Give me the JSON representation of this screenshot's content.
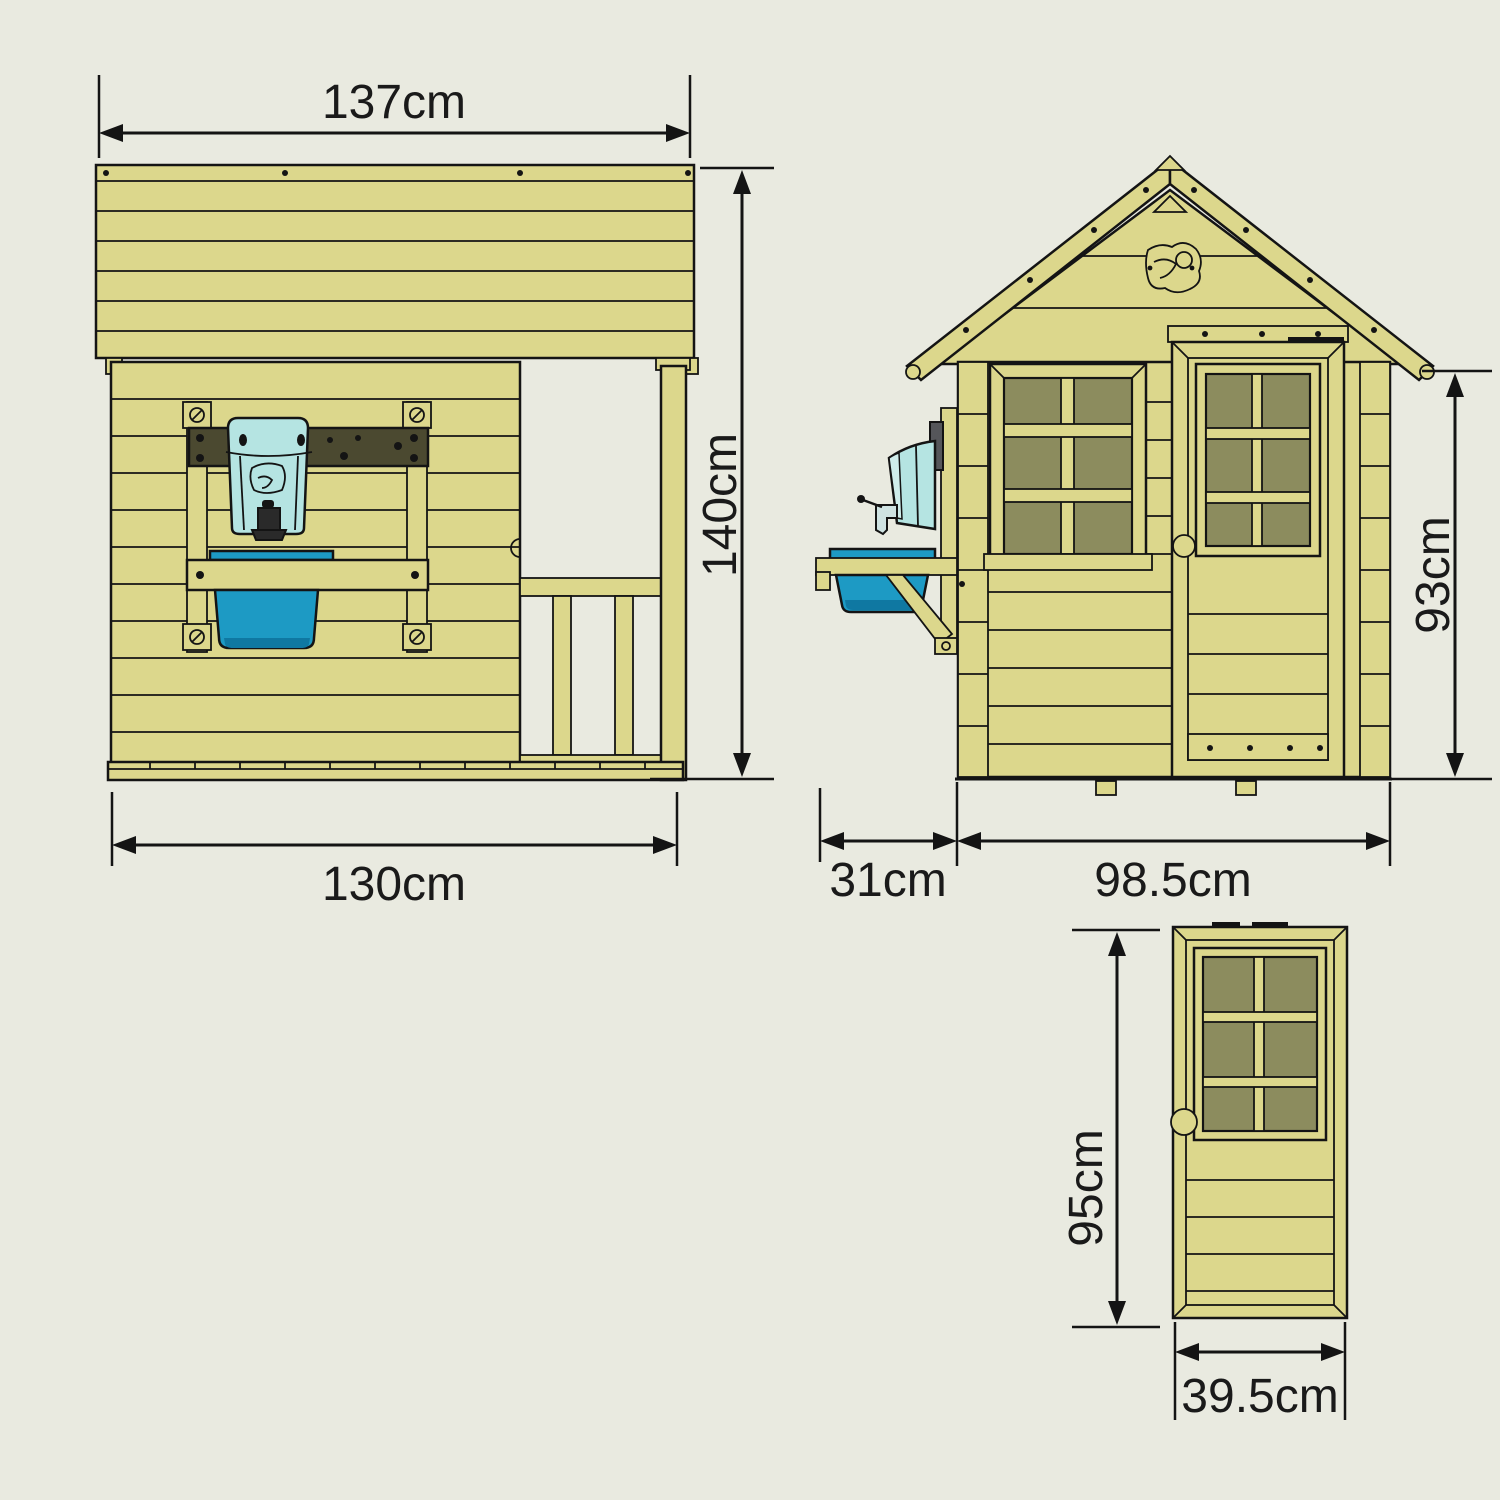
{
  "background": "#E9EAE0",
  "colors": {
    "wood": "#DCD78C",
    "outline": "#141414",
    "window_glass": "#8C8C5E",
    "mounting_board_brown": "#4B4930",
    "water_dispenser_blue": "#B5E4E2",
    "tub_blue": "#1D9AC4",
    "tub_shadow_blue": "#0F78A2",
    "bracket_gray": "#55565A"
  },
  "views": {
    "side": {
      "name": "side-elevation",
      "dim_roof_width": "137cm",
      "dim_total_height": "140cm",
      "dim_base_width": "130cm"
    },
    "front": {
      "name": "front-elevation",
      "dim_wall_height": "93cm",
      "dim_kitchen_depth": "31cm",
      "dim_body_width": "98.5cm"
    },
    "door": {
      "name": "door-detail",
      "dim_height": "95cm",
      "dim_width": "39.5cm"
    }
  }
}
